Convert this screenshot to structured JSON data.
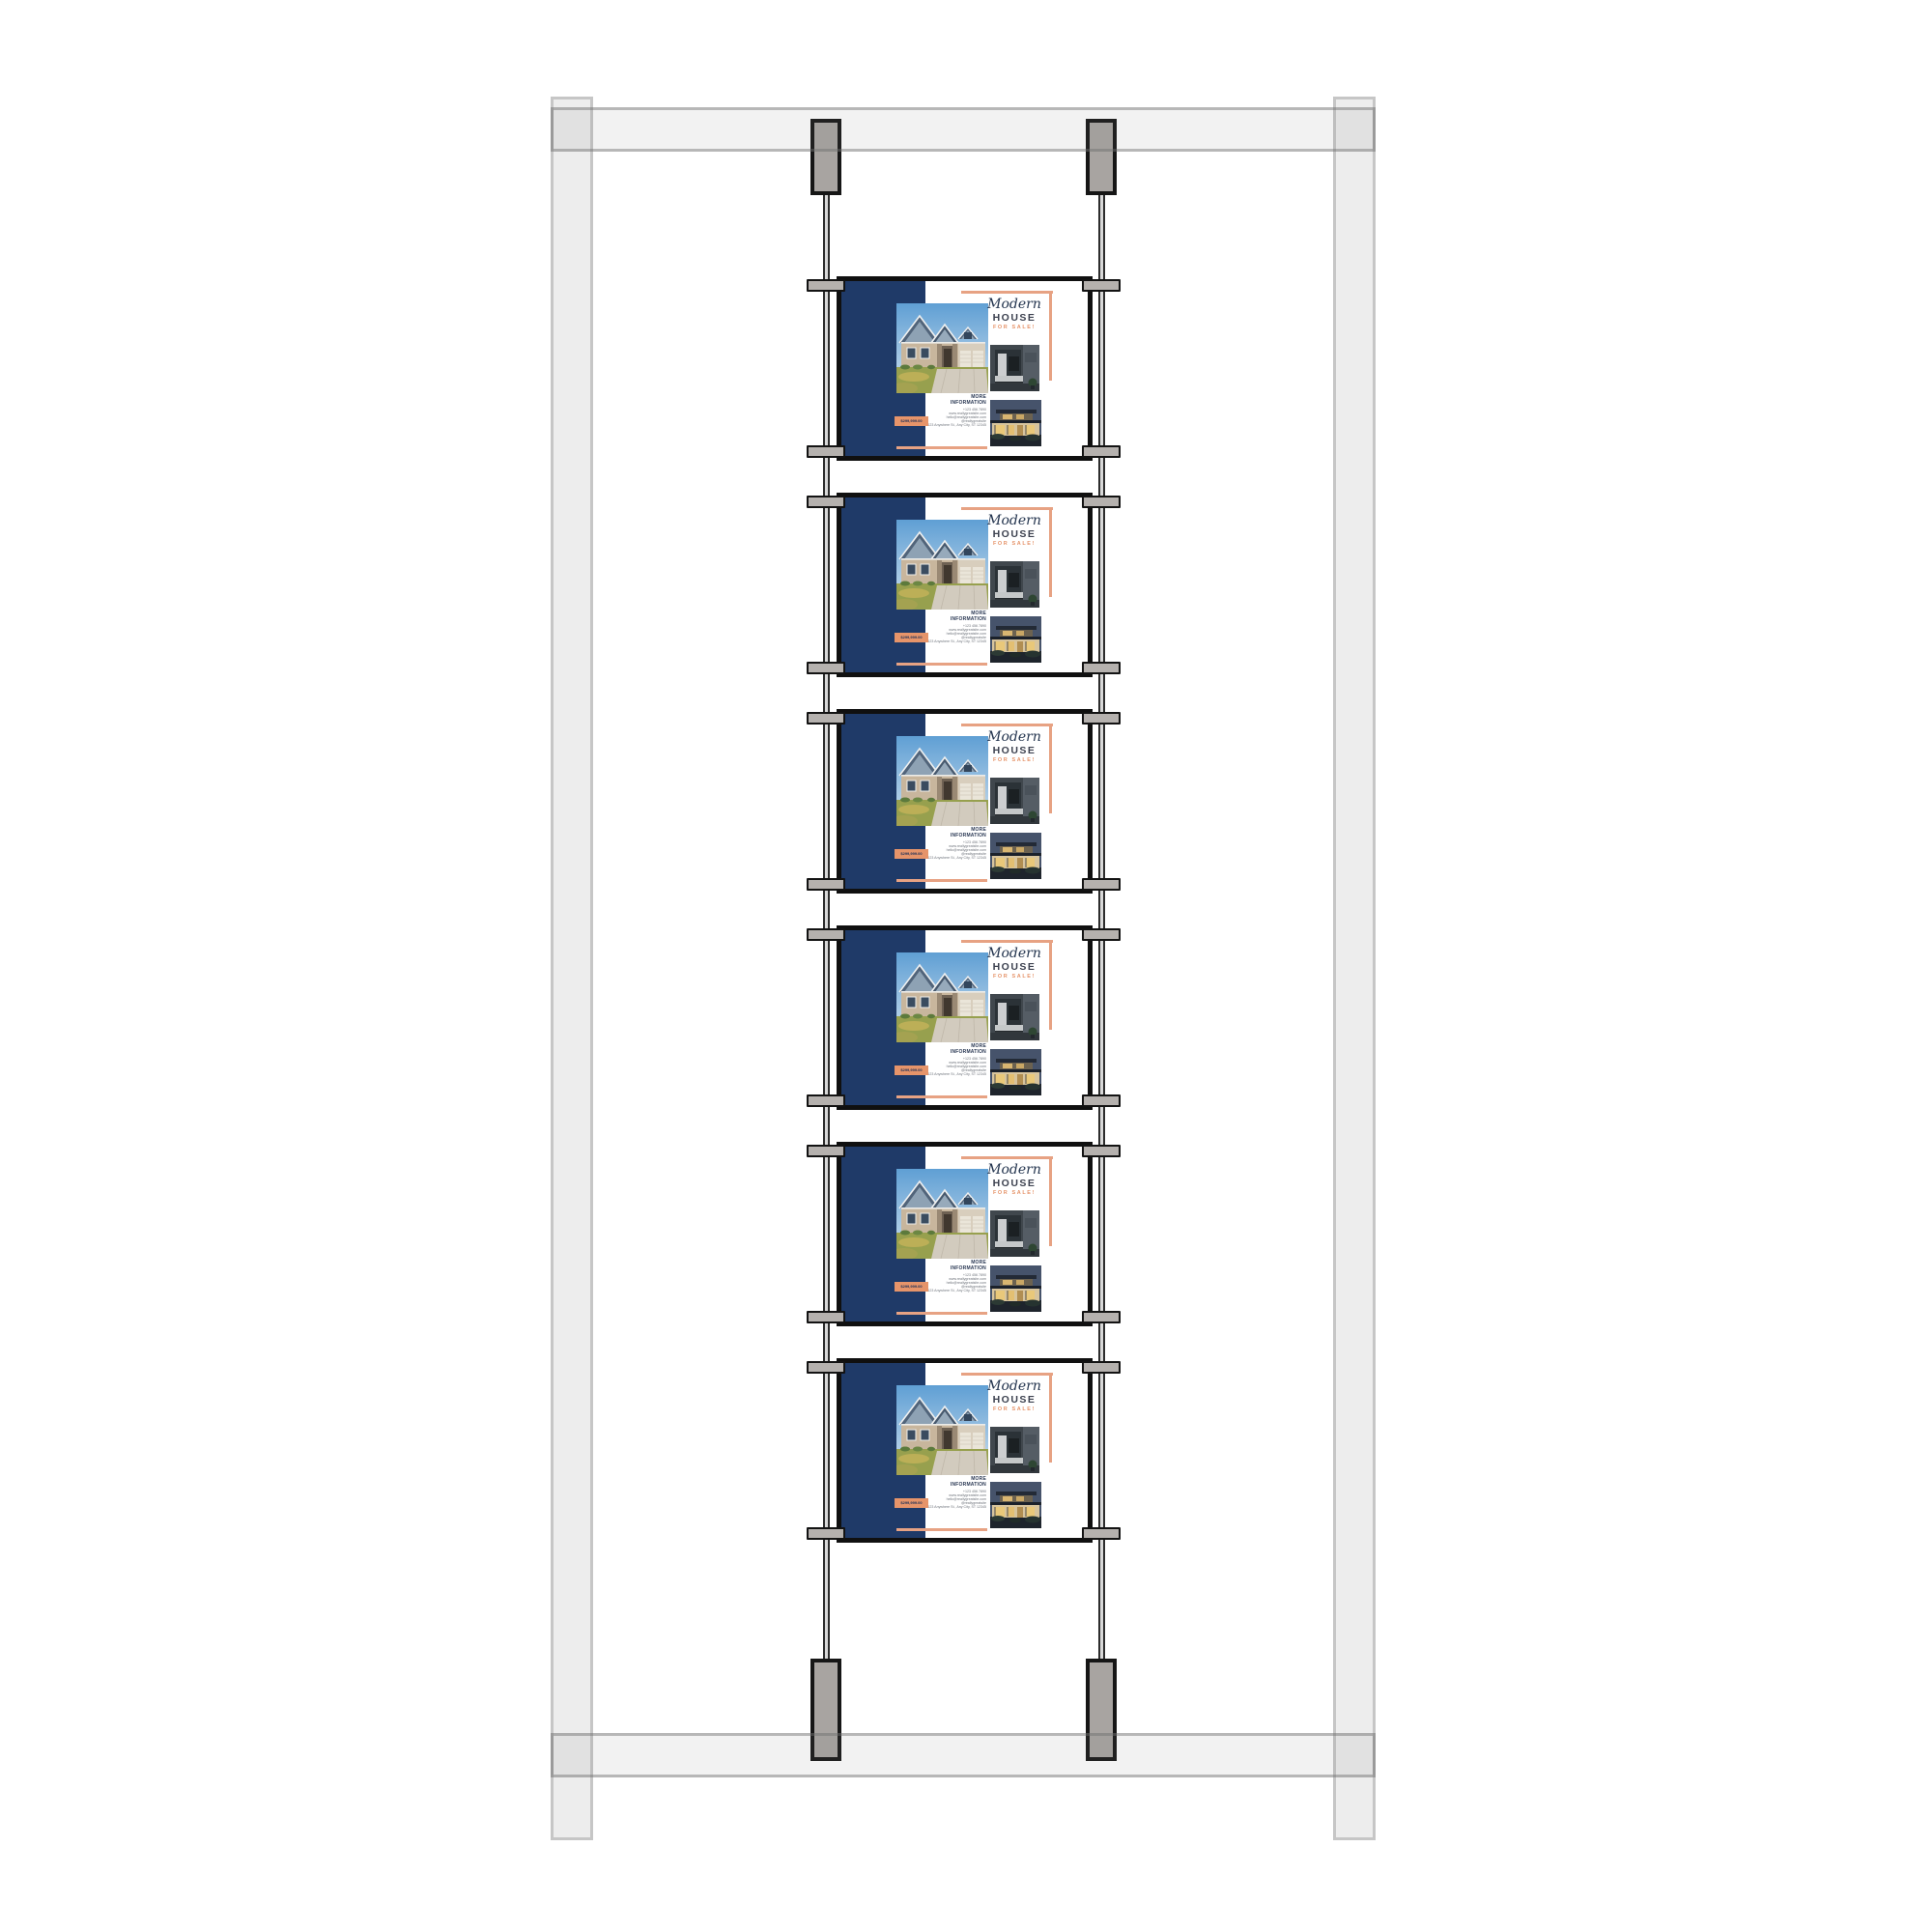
{
  "scene": {
    "description": "cable-suspended poster display kit mockup",
    "poster_count": 6
  },
  "flyer": {
    "brand_script": "Modern",
    "title": "HOUSE",
    "subtitle": "FOR SALE!",
    "info_label_line1": "MORE",
    "info_label_line2": "INFORMATION",
    "contact_lines": [
      "+123 456 7890",
      "www.reallygreatsite.com",
      "hello@reallygreatsite.com",
      "@reallygreatsite",
      "123 Anywhere St., Any City, ST 12345"
    ],
    "price": "$299,999.00",
    "photos": [
      "main-house-photo",
      "interior-photo",
      "dusk-house-photo"
    ]
  },
  "colors": {
    "navy": "#1F3A68",
    "salmon": "#E7A283",
    "salmon_deep": "#E6946A",
    "frame_gray": "#EDEDED",
    "hardware_gray": "#A8A4A1",
    "clamp_gray": "#B5B1AE",
    "poster_border": "#101010",
    "title_ink": "#3D4250",
    "background": "#FFFFFF"
  }
}
